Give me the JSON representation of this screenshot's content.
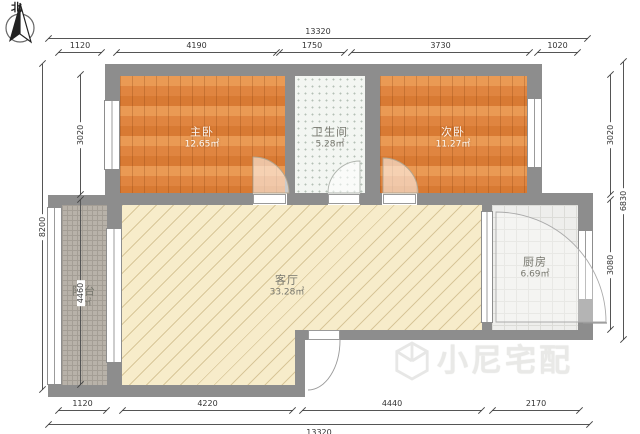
{
  "compass": {
    "label": "北"
  },
  "rooms": {
    "master": {
      "name": "主卧",
      "area": "12.65㎡"
    },
    "bathroom": {
      "name": "卫生间",
      "area": "5.28㎡"
    },
    "second": {
      "name": "次卧",
      "area": "11.27㎡"
    },
    "living": {
      "name": "客厅",
      "area": "33.28㎡"
    },
    "balcony": {
      "name": "阳台",
      "area": "5㎡"
    },
    "kitchen": {
      "name": "厨房",
      "area": "6.69㎡"
    }
  },
  "dimensions": {
    "top": {
      "total": "13320",
      "segments": [
        "1120",
        "4190",
        "1750",
        "3730",
        "1020"
      ]
    },
    "bottom": {
      "total": "13320",
      "segments": [
        "1120",
        "4220",
        "4440",
        "2170"
      ]
    },
    "left": {
      "total": "8200",
      "segments": [
        "3020",
        "4460"
      ]
    },
    "right": {
      "total": "6830",
      "segments": [
        "3020",
        "3080"
      ]
    }
  },
  "watermark": {
    "text": "小尼宅配"
  },
  "colors": {
    "wall": "#8d8d8d",
    "wood_floor": "#e08540",
    "living_floor": "#f7ecca",
    "balcony_floor": "#b8b2a9",
    "kitchen_floor": "#eeeeec",
    "bathroom_floor": "#f3f6f2"
  }
}
